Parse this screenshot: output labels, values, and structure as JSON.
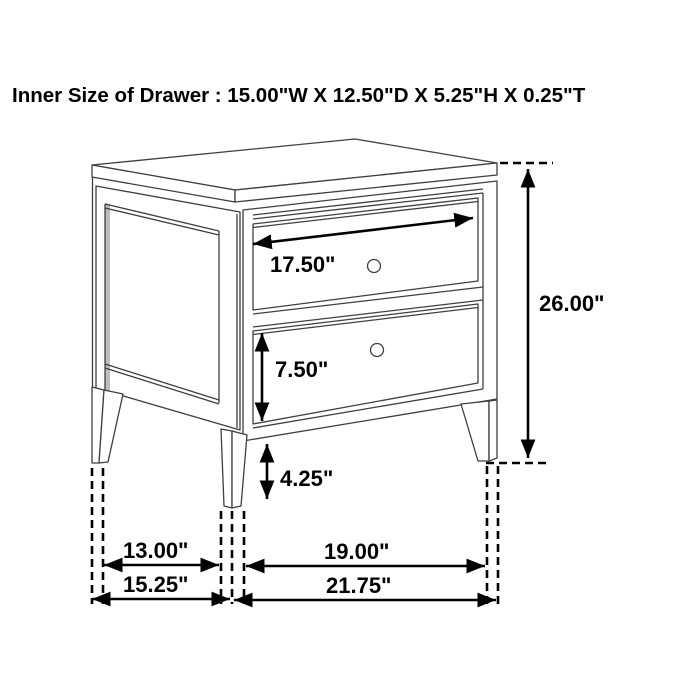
{
  "title": "Inner Size of Drawer : 15.00\"W X 12.50\"D X 5.25\"H X 0.25\"T",
  "diagram": {
    "subject": "two-drawer nightstand dimension drawing",
    "dimensions": {
      "drawer_front_width": "17.50\"",
      "lower_drawer_height": "7.50\"",
      "leg_height": "4.25\"",
      "overall_height": "26.00\"",
      "side_leg_spacing": "13.00\"",
      "overall_depth": "15.25\"",
      "front_leg_spacing": "19.00\"",
      "overall_width": "21.75\""
    }
  }
}
